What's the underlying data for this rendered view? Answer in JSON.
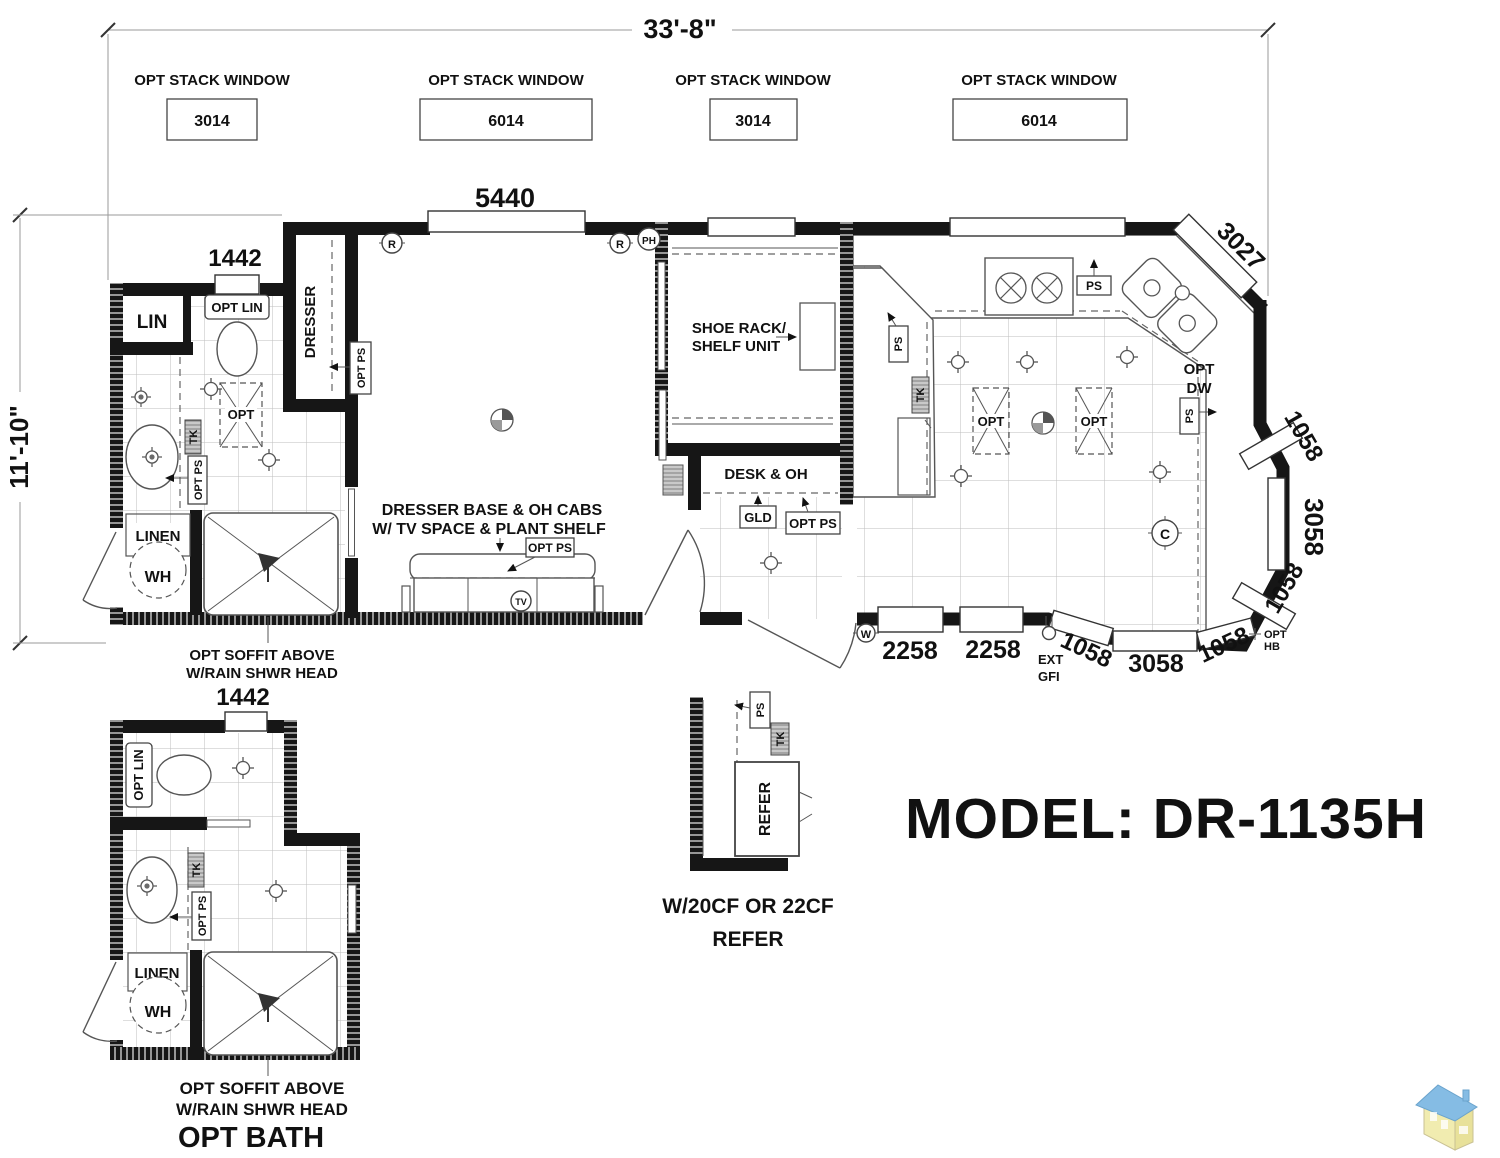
{
  "colors": {
    "ink": "#111111",
    "wall": "#161616",
    "grid": "#bdbdbd",
    "gray_fixture": "#c9c9c9",
    "logo_roof": "#85bce4",
    "logo_body": "#f1ecb0"
  },
  "dims": {
    "overall_width": "33'-8\"",
    "overall_depth": "11'-10\"",
    "bedroom_window": "5440",
    "bath_window": "1442",
    "optbath_window": "1442",
    "corner_window": "3027",
    "right_top": "1058",
    "right_mid": "3058",
    "right_bottom": "1058",
    "seat1": "2258",
    "seat2": "2258",
    "bottom_a": "1058",
    "bottom_b": "3058",
    "bottom_c": "1058"
  },
  "stack_windows": [
    {
      "label": "OPT STACK WINDOW",
      "size": "3014"
    },
    {
      "label": "OPT STACK WINDOW",
      "size": "6014"
    },
    {
      "label": "OPT STACK WINDOW",
      "size": "3014"
    },
    {
      "label": "OPT STACK WINDOW",
      "size": "6014"
    }
  ],
  "bath": {
    "lin": "LIN",
    "opt_lin": "OPT LIN",
    "opt": "OPT",
    "tk": "TK",
    "opt_ps": "OPT PS",
    "linen": "LINEN",
    "wh": "WH",
    "soffit1": "OPT SOFFIT ABOVE",
    "soffit2": "W/RAIN SHWR HEAD"
  },
  "bedroom": {
    "dresser": "DRESSER",
    "opt_ps": "OPT PS",
    "base1": "DRESSER BASE & OH CABS",
    "base2": "W/ TV SPACE & PLANT SHELF",
    "opt_ps_tv": "OPT PS"
  },
  "entry": {
    "shoe1": "SHOE RACK/",
    "shoe2": "SHELF UNIT",
    "desk": "DESK & OH",
    "gld": "GLD",
    "opt_ps": "OPT PS"
  },
  "kitchen": {
    "ps_range": "PS",
    "ps_wall": "PS",
    "tk": "TK",
    "opt1": "OPT",
    "opt2": "OPT",
    "optdw1": "OPT",
    "optdw2": "DW",
    "ps_dw": "PS",
    "ext1": "EXT",
    "ext2": "GFI",
    "opthb1": "OPT",
    "opthb2": "HB"
  },
  "optbath": {
    "opt_lin": "OPT LIN",
    "tk": "TK",
    "opt_ps": "OPT PS",
    "linen": "LINEN",
    "wh": "WH",
    "soffit1": "OPT SOFFIT ABOVE",
    "soffit2": "W/RAIN SHWR HEAD",
    "title": "OPT BATH"
  },
  "refer": {
    "ps": "PS",
    "tk": "TK",
    "unit": "REFER",
    "cap1": "W/20CF OR 22CF",
    "cap2": "REFER"
  },
  "symbols": {
    "r": "R",
    "ph": "PH",
    "w": "W",
    "c": "C",
    "tv": "TV"
  },
  "model": "MODEL: DR-1135H"
}
